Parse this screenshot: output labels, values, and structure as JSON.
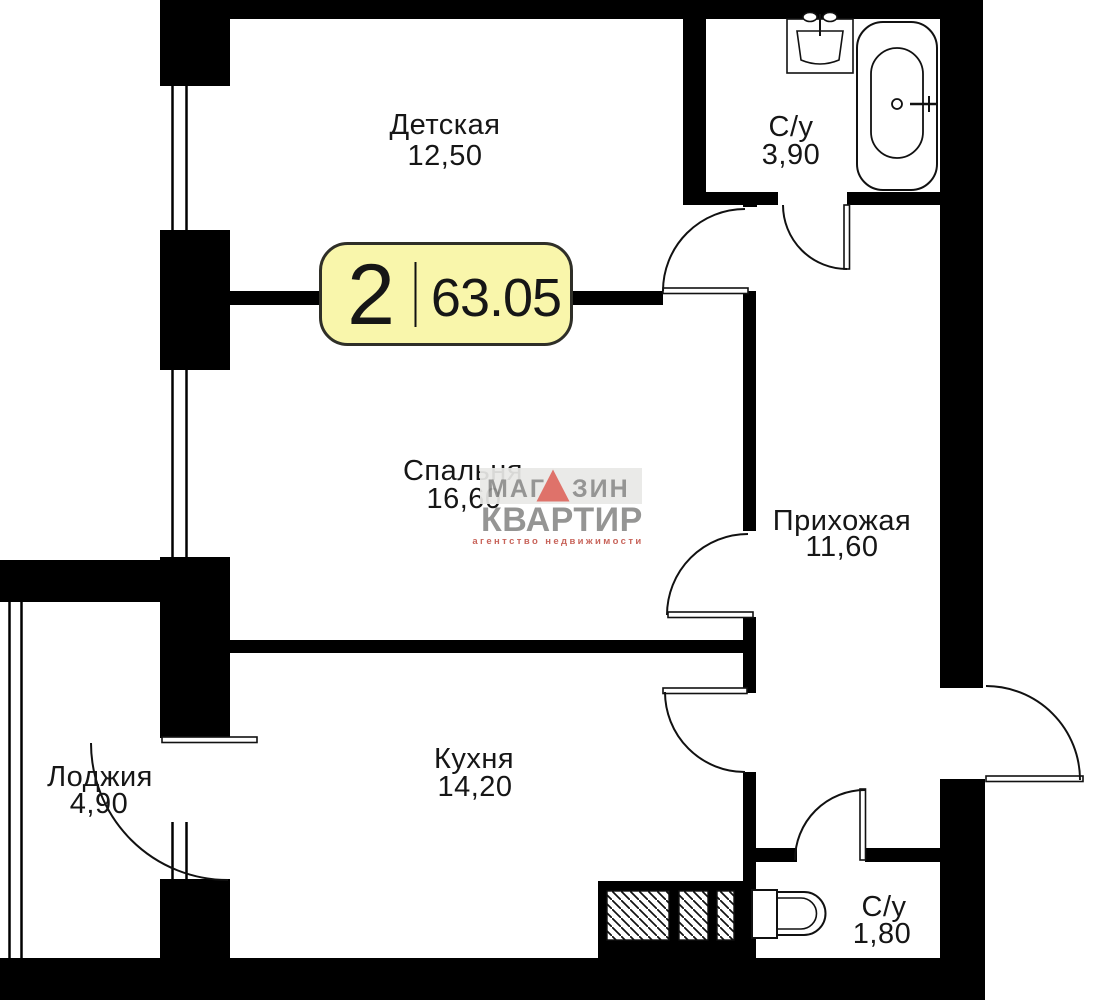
{
  "plan": {
    "badge": {
      "rooms_count": "2",
      "total_area": "63.05"
    },
    "rooms": [
      {
        "id": "nursery",
        "name": "Детская",
        "area": "12,50"
      },
      {
        "id": "bathroom-main",
        "name": "С/у",
        "area": "3,90"
      },
      {
        "id": "bedroom",
        "name": "Спальня",
        "area": "16,60"
      },
      {
        "id": "hallway",
        "name": "Прихожая",
        "area": "11,60"
      },
      {
        "id": "loggia",
        "name": "Лоджия",
        "area": "4,90"
      },
      {
        "id": "kitchen",
        "name": "Кухня",
        "area": "14,20"
      },
      {
        "id": "bathroom-guest",
        "name": "С/у",
        "area": "1,80"
      }
    ],
    "watermark": {
      "brand_top_left": "МАГ",
      "brand_top_right": "ЗИН",
      "brand_bottom": "КВАРТИР",
      "tagline": "агентство  недвижимости"
    },
    "colors": {
      "wall": "#000000",
      "line": "#111111",
      "badge_fill": "#f9f6ab",
      "badge_border": "#2f2f28",
      "watermark_gray": "#8d8d8b",
      "watermark_red": "#dd675e",
      "watermark_tagline": "#c4574d",
      "watermark_bg": "#e9e9e7"
    }
  }
}
